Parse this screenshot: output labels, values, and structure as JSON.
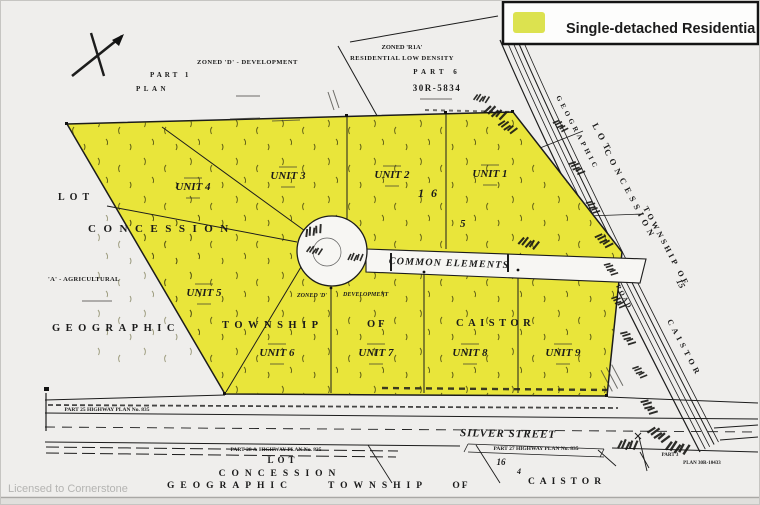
{
  "legend": {
    "label": "Single-detached Residentia",
    "swatch_color": "#dce24f"
  },
  "watermark": "Licensed to Cornerstone",
  "map_colors": {
    "parcel_yellow": "#e9e53a",
    "line_black": "#1c1c1c",
    "paper": "#efeeec"
  },
  "top_left": {
    "zoned": "ZONED 'D' - DEVELOPMENT",
    "part": "PART 1",
    "plan": "PLAN"
  },
  "north_parcel": {
    "zoned": "ZONED 'R1A'",
    "density": "RESIDENTIAL LOW DENSITY",
    "part": "PART 6",
    "plan_no": "30R-5834"
  },
  "west_labels": {
    "lot": "LOT",
    "concession": "CONCESSION",
    "agricultural": "'A' - AGRICULTURAL",
    "geographic": "GEOGRAPHIC"
  },
  "mid_labels": {
    "township": "TOWNSHIP",
    "of": "OF",
    "caistor": "CAISTOR",
    "lot_number": "1 6",
    "concession_number": "5",
    "zoned": "ZONED 'D'",
    "development": "DEVELOPMENT",
    "common_elements": "COMMON ELEMENTS"
  },
  "units": [
    {
      "label": "UNIT 1"
    },
    {
      "label": "UNIT 2"
    },
    {
      "label": "UNIT 3"
    },
    {
      "label": "UNIT 4"
    },
    {
      "label": "UNIT 5"
    },
    {
      "label": "UNIT 6"
    },
    {
      "label": "UNIT 7"
    },
    {
      "label": "UNIT 8"
    },
    {
      "label": "UNIT 9"
    }
  ],
  "east_road": {
    "geographic": "GEOGRAPHIC",
    "lot": "LOT",
    "concession": "CONCESSION",
    "township_of": "TOWNSHIP OF",
    "road": "ROAD",
    "fifteen": "15",
    "caistor": "CAISTOR"
  },
  "south": {
    "street": "SILVER STREET",
    "part25": "PART 25   HIGHWAY PLAN No. 835",
    "part27": "PART 27   HIGHWAY  PLAN  No. 835",
    "part28": "PART 28 &  HIGHWAY  PLAN  No. 835",
    "part3": "PART 3",
    "plan30r": "PLAN 30R-10433",
    "lot": "LOT",
    "concession": "CONCESSION",
    "geographic": "GEOGRAPHIC",
    "township": "TOWNSHIP",
    "of": "OF",
    "caistor": "CAISTOR",
    "sixteen": "16",
    "four": "4"
  }
}
